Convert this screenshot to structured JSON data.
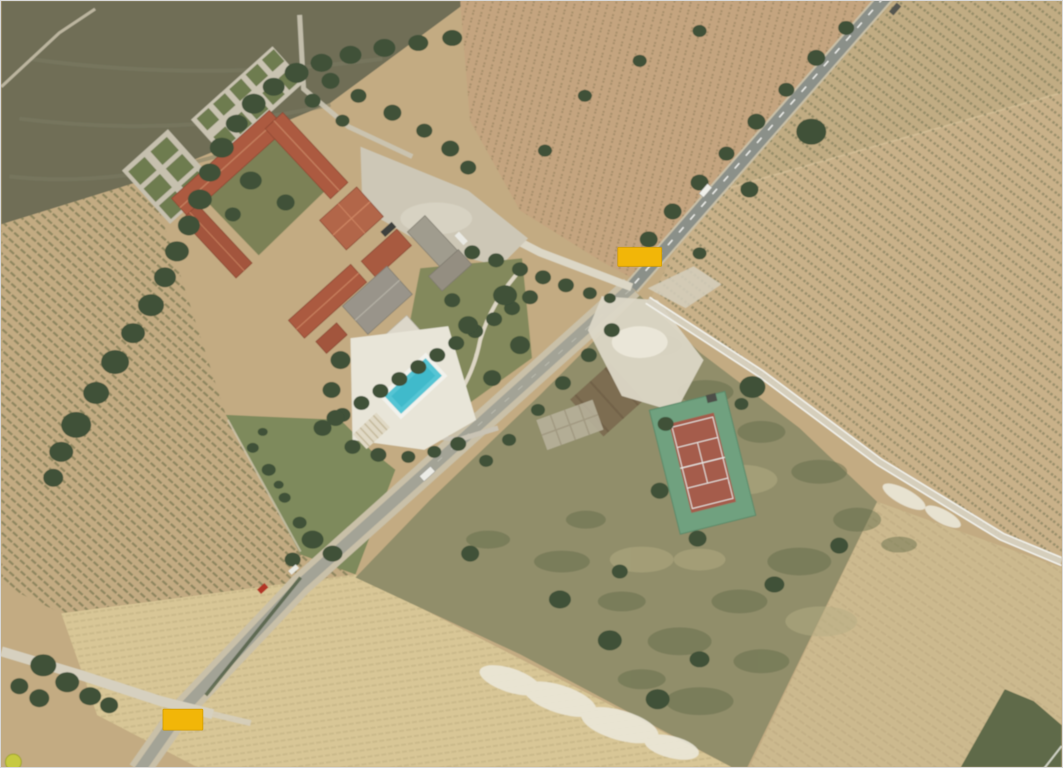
{
  "view": {
    "type": "satellite-aerial-imagery",
    "description": "Aerial satellite view of a rural wine estate: vineyard fields, a U-shaped farm complex with terracotta roofs, parterre gardens, swimming pool, tennis court, a diagonal two-lane road with two junctions marked by blank amber road-label boxes, a white twin-track farm path and scrubland.",
    "width_px": 1063,
    "height_px": 768
  },
  "road_labels": [
    {
      "text": "",
      "x": 618,
      "y": 247,
      "width": 44,
      "height": 19
    },
    {
      "text": "",
      "x": 162,
      "y": 710,
      "width": 40,
      "height": 21
    }
  ],
  "features": {
    "canvas": "Satellite imagery canvas",
    "farm": "Farm estate with terracotta-roofed buildings",
    "courtyard": "Farm courtyard",
    "parterre": "Parterre garden",
    "parking": "Gravel parking area",
    "pool": "Swimming pool",
    "tennis": "Tennis court",
    "main_road": "Main road",
    "access_road": "Farm access road",
    "farm_track": "White twin-track farm path",
    "gravel_road": "Gravel side road",
    "vineyard": "Vineyard field with planted rows",
    "plowed_field": "Dark plowed field",
    "scrub": "Uncultivated scrubland",
    "marker": "Road label marker"
  },
  "colors": {
    "field_base": "#C3AB82",
    "field_dark": "#6F6E57",
    "field_top_middle": "#C4A47F",
    "field_right": "#C9B189",
    "field_bottom_right": "#CCB98E",
    "field_pale": "#D8C696",
    "verge_green": "#7E8A5C",
    "scrub": "#918E6A",
    "scrub_dark": "#5F6A48",
    "tree": "#3F5139",
    "road_asphalt": "#8B9089",
    "road_lower": "#A3A396",
    "road_verge": "#C9C0A8",
    "gravel": "#D6D0BF",
    "gravel_bright": "#DCD7C6",
    "track_base": "#D7D2C1",
    "white_line": "#F2F2EC",
    "roof": "#AC5A40",
    "roof_gray": "#99948A",
    "building_white": "#DCD7C9",
    "parking": "#CDC7B6",
    "courtyard": "#7B8156",
    "garden": "#83895C",
    "parterre_green": "#6E7B4F",
    "parterre_base": "#C9C3B1",
    "deck": "#E8E5D8",
    "pool": "#55C5D4",
    "pool_lane": "#3EB7C9",
    "tennis_out": "#6FA17F",
    "tennis_in": "#A55C4B",
    "court_line": "#E9E9E5",
    "chalk": "#EBE8DA",
    "marker": "#F2B608",
    "marker_border": "#D19C00",
    "row_left": "#6A6D48",
    "row_right": "#6F7250",
    "row_top": "#8A7A58",
    "row_pale": "#BFAE80",
    "row_br": "#B3A179"
  }
}
